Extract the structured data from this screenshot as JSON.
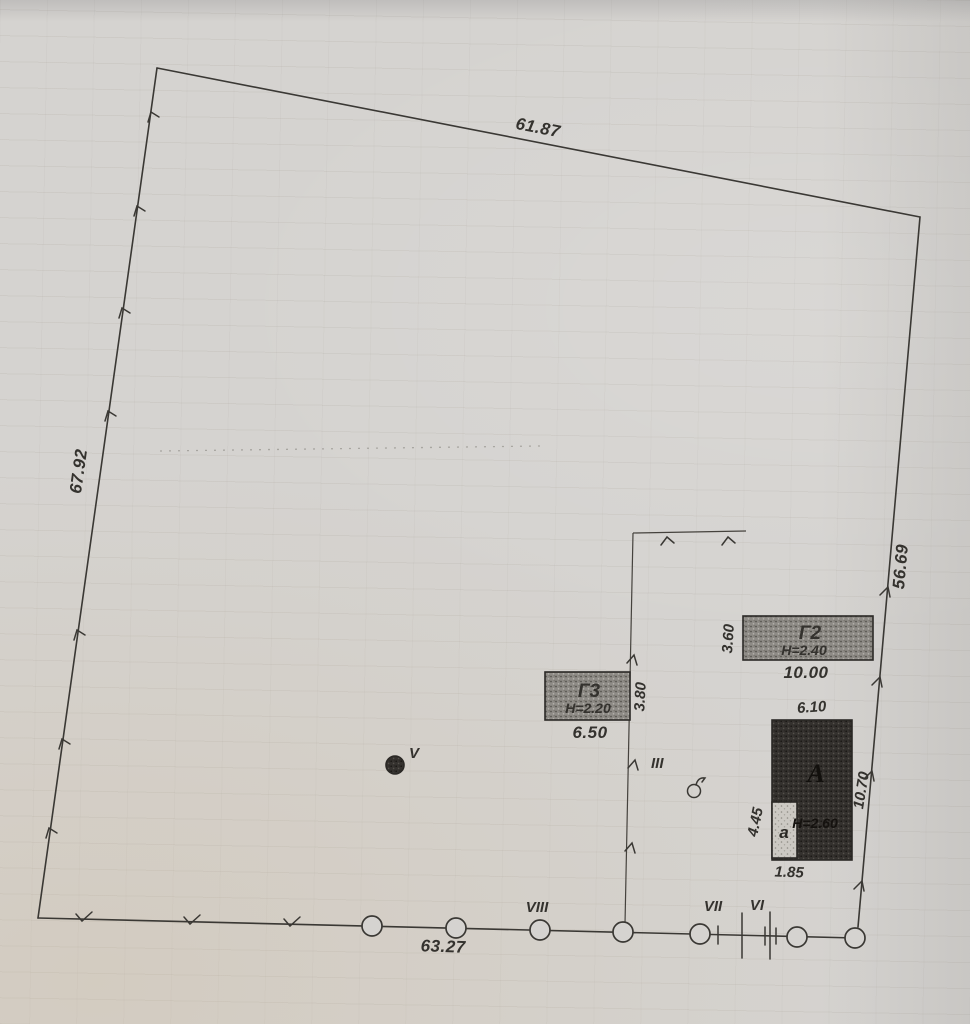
{
  "plan": {
    "dimensions": {
      "top": "61.87",
      "left": "67.92",
      "right": "56.69",
      "bottom": "63.27",
      "inner_vertical": "3.80"
    },
    "buildings": {
      "g2": {
        "label": "Г2",
        "height": "H=2.40",
        "length": "10.00",
        "width": "3.60"
      },
      "g3": {
        "label": "Г3",
        "height": "H=2.20",
        "length": "6.50"
      },
      "main": {
        "label": "А",
        "height": "H=2.60",
        "top_width": "6.10",
        "side_length": "10.70"
      },
      "porch": {
        "label": "а",
        "side": "4.45",
        "bottom": "1.85"
      }
    },
    "points": {
      "v": "V",
      "iii": "III",
      "viii": "VIII",
      "vii": "VII",
      "vi": "VI"
    },
    "colors": {
      "ink": "#3a3834",
      "paper": "#d5d3d0",
      "building_medium": "#8e8b86",
      "building_dark": "#34312e",
      "porch_light": "#ccc9c3"
    }
  }
}
